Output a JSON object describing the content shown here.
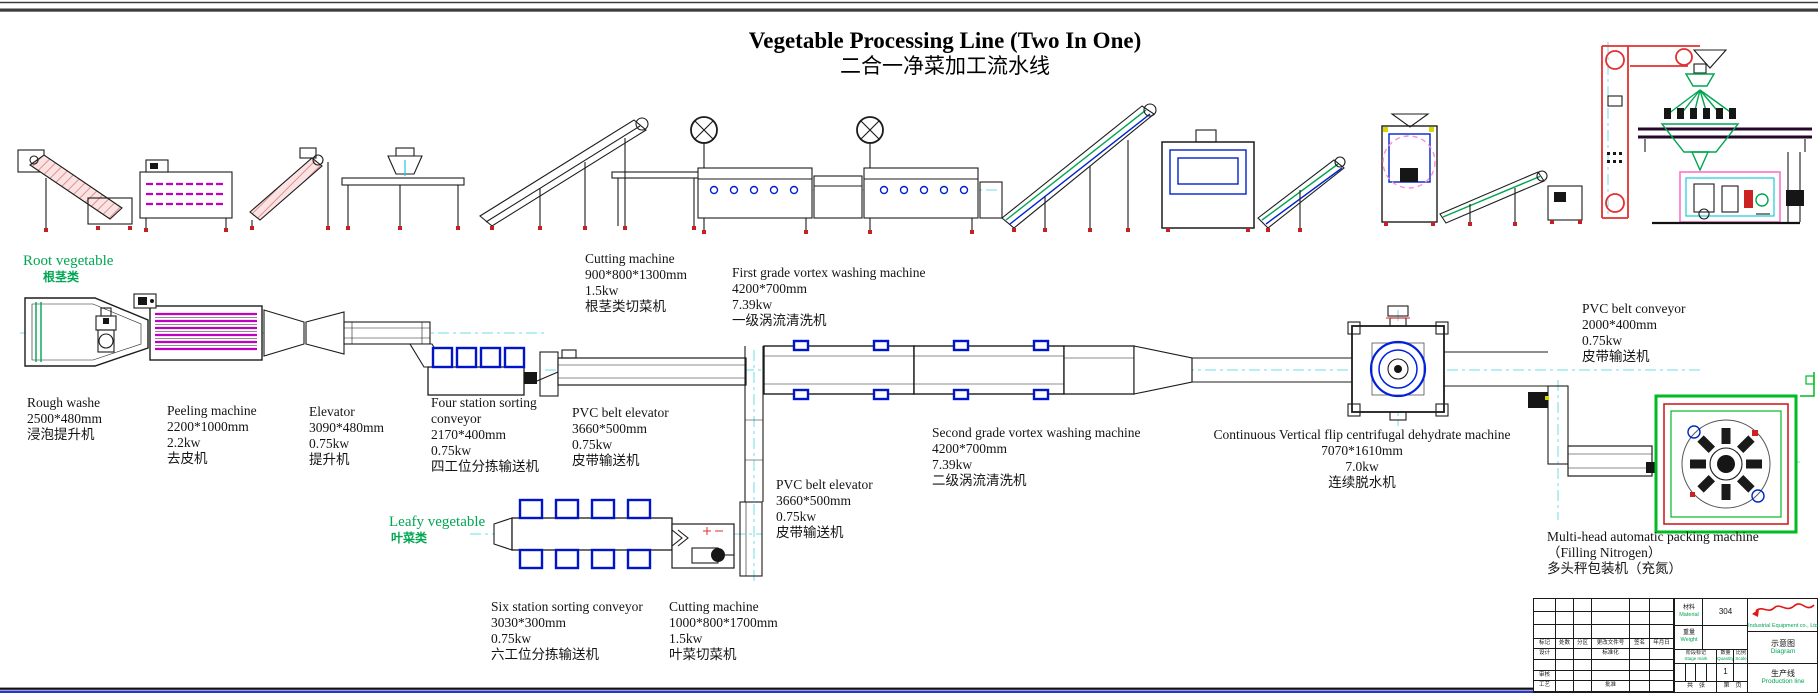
{
  "title": {
    "en": "Vegetable Processing Line (Two In One)",
    "zh": "二合一净菜加工流水线"
  },
  "section_labels": {
    "root": {
      "en": "Root vegetable",
      "zh": "根茎类"
    },
    "leafy": {
      "en": "Leafy vegetable",
      "zh": "叶菜类"
    }
  },
  "machine_labels": [
    {
      "id": "rough-washer",
      "name": "Rough washe",
      "dims": "2500*480mm",
      "zh": "浸泡提升机"
    },
    {
      "id": "peeling-machine",
      "name": "Peeling machine",
      "dims": "2200*1000mm",
      "power": "2.2kw",
      "zh": "去皮机"
    },
    {
      "id": "elevator",
      "name": "Elevator",
      "dims": "3090*480mm",
      "power": "0.75kw",
      "zh": "提升机"
    },
    {
      "id": "four-station-sorting-conveyor",
      "name": "Four station sorting conveyor",
      "dims": "2170*400mm",
      "power": "0.75kw",
      "zh": "四工位分拣输送机"
    },
    {
      "id": "pvc-belt-elevator-root",
      "name": "PVC belt elevator",
      "dims": "3660*500mm",
      "power": "0.75kw",
      "zh": "皮带输送机"
    },
    {
      "id": "cutting-machine-root",
      "name": "Cutting machine",
      "dims": "900*800*1300mm",
      "power": "1.5kw",
      "zh": "根茎类切菜机"
    },
    {
      "id": "first-grade-vortex-washer",
      "name": "First grade vortex washing machine",
      "dims": "4200*700mm",
      "power": "7.39kw",
      "zh": "一级涡流清洗机"
    },
    {
      "id": "pvc-belt-elevator-leafy",
      "name": "PVC belt elevator",
      "dims": "3660*500mm",
      "power": "0.75kw",
      "zh": "皮带输送机"
    },
    {
      "id": "second-grade-vortex-washer",
      "name": "Second grade vortex washing machine",
      "dims": "4200*700mm",
      "power": "7.39kw",
      "zh": "二级涡流清洗机"
    },
    {
      "id": "centrifugal-dehydrator",
      "name": "Continuous Vertical flip centrifugal dehydrate machine",
      "dims": "7070*1610mm",
      "power": "7.0kw",
      "zh": "连续脱水机"
    },
    {
      "id": "pvc-belt-conveyor",
      "name": "PVC belt conveyor",
      "dims": "2000*400mm",
      "power": "0.75kw",
      "zh": "皮带输送机"
    },
    {
      "id": "six-station-sorting-conveyor",
      "name": "Six station sorting conveyor",
      "dims": "3030*300mm",
      "power": "0.75kw",
      "zh": "六工位分拣输送机"
    },
    {
      "id": "cutting-machine-leafy",
      "name": "Cutting machine",
      "dims": "1000*800*1700mm",
      "power": "1.5kw",
      "zh": "叶菜切菜机"
    },
    {
      "id": "multi-head-packing-machine",
      "name": "Multi-head automatic packing machine",
      "name2": "（Filling Nitrogen）",
      "zh": "多头秤包装机（充氮）"
    }
  ],
  "title_block": {
    "material_zh": "材料",
    "material_en": "Material",
    "material_value": "304",
    "weight_zh": "重量",
    "weight_en": "Weight",
    "stage_zh": "阶段标记",
    "stage_en": "Stage mark",
    "quantity_zh": "数量",
    "quantity_en": "Quantity",
    "quantity_value": "1",
    "scale_zh": "比例",
    "scale_en": "Scale",
    "sheet_left": "共　张",
    "sheet_right": "第　页",
    "company_en": "Industrial Equipment co., Ltd",
    "drawing_type_zh": "示意图",
    "drawing_type_en": "Diagram",
    "drawing_name_zh": "生产线",
    "drawing_name_en": "Production line",
    "rev_cols": [
      "标记",
      "处数",
      "分区",
      "更改文件号",
      "签名",
      "年月日"
    ],
    "design": "设计",
    "standardization": "标准化",
    "audit": "审核",
    "process": "工艺",
    "approve": "批准"
  },
  "colors": {
    "section_green": "#00a651",
    "centerline_cyan": "#6edde9",
    "detail_blue": "#0014cc",
    "elevator_red": "#e23131",
    "stripe_magenta": "#c000c0",
    "packing_pink": "#ff7fd0",
    "frame_bottom_blue": "#2b35c8"
  }
}
